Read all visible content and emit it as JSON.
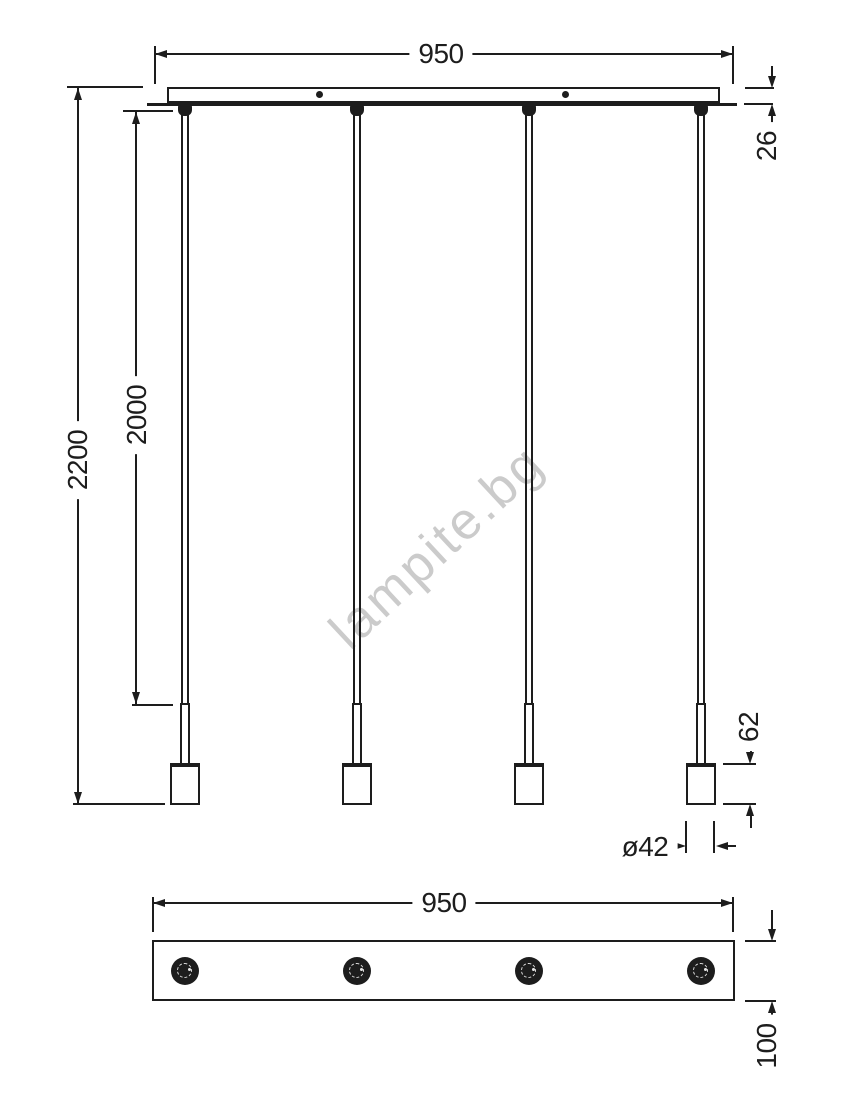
{
  "colors": {
    "line": "#1d1d1d",
    "background": "#ffffff",
    "watermark": "#cbcbcb"
  },
  "watermark": {
    "text": "lampite.bg",
    "rotation_deg": -43
  },
  "front_view": {
    "width_label": "950",
    "canopy_thickness_label": "26",
    "overall_height_label": "2200",
    "cable_length_label": "2000",
    "holder_height_label": "62",
    "holder_diameter_label": "ø42",
    "pendant_count": 4
  },
  "bottom_view": {
    "width_label": "950",
    "depth_label": "100",
    "socket_count": 4
  }
}
